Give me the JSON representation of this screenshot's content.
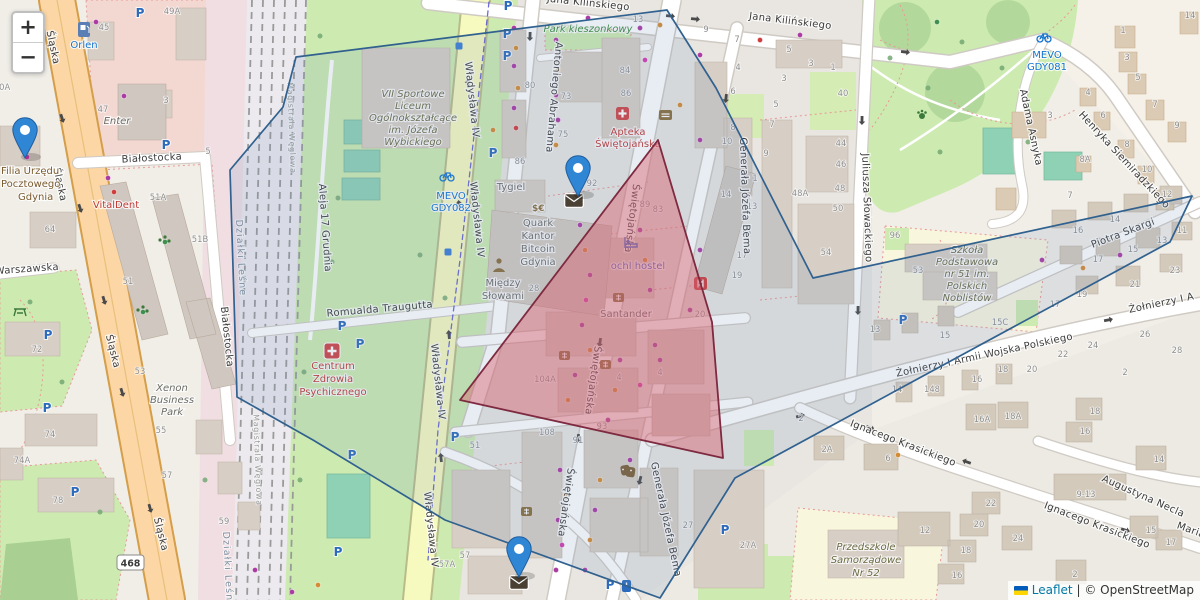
{
  "ui": {
    "zoom_in": "+",
    "zoom_out": "−",
    "attribution_leaflet": "Leaflet",
    "attribution_sep": "|",
    "attribution_osm": "© OpenStreetMap"
  },
  "icons": {
    "parking": "P",
    "currency": "$€"
  },
  "streets": {
    "slaska": "Śląska",
    "bialostocka": "Białostocka",
    "warszawska": "Warszawska",
    "wladyslawa": "Władysława IV",
    "swietojanska": "Świętojańska",
    "abrahama": "Antoniego Abrahama",
    "kilinskiego": "Jana Kilińskiego",
    "bema": "Generała Józefa Bema",
    "slowackiego": "Juliusza Słowackiego",
    "siemiradzkiego": "Henryka Siemiradzkiego",
    "asnyka": "Adama Asnyka",
    "skargi": "Piotra Skargi",
    "zolnierzy": "Żołnierzy I Armii Wojska Polskiego",
    "zolnierzy_clip": "Żołnierzy I A",
    "krasickiego": "Ignacego Krasickiego",
    "necla": "Augustyna Necla",
    "traugutta": "Romualda Traugutta",
    "grudnia": "Aleja 17 Grudnia",
    "maria": "Maria",
    "ref_468": "468"
  },
  "areas": {
    "dzialki": "Działki Leśne",
    "magistrala": "Magistrala Węglowa",
    "park_kieszonkowy": "Park kieszonkowy"
  },
  "pois": {
    "orlen": "Orlen",
    "vitaldent": "VitalDent",
    "enter": "Enter",
    "tygiel": "Tygiel",
    "santander": "Santander",
    "ochl": "ochl hostel",
    "filia": {
      "l1": "Filia Urzędu",
      "l2": "Pocztowego",
      "l3": "Gdynia"
    },
    "xenon": {
      "l1": "Xenon",
      "l2": "Business",
      "l3": "Park"
    },
    "liceum": {
      "l1": "VII Sportowe",
      "l2": "Liceum",
      "l3": "Ogólnokształcące",
      "l4": "im. Józefa",
      "l5": "Wybickiego"
    },
    "apteka": {
      "l1": "Apteka",
      "l2": "Świętojańska"
    },
    "quark": {
      "l1": "Quark",
      "l2": "Kantor",
      "l3": "Bitcoin",
      "l4": "Gdynia"
    },
    "miedzy": {
      "l1": "Między",
      "l2": "Słowami"
    },
    "centrum": {
      "l1": "Centrum",
      "l2": "Zdrowia",
      "l3": "Psychicznego"
    },
    "szkola": {
      "l1": "Szkoła",
      "l2": "Podstawowa",
      "l3": "nr 51 im.",
      "l4": "Polskich",
      "l5": "Noblistów"
    },
    "przedszkole": {
      "l1": "Przedszkole",
      "l2": "Samorządowe",
      "l3": "Nr 52"
    },
    "mevo1": {
      "l1": "MEVO",
      "l2": "GDY081"
    },
    "mevo2": {
      "l1": "MEVO",
      "l2": "GDY082"
    }
  },
  "colors": {
    "marker": "#2f86d4",
    "polygon_blue_stroke": "#30618f",
    "polygon_red_stroke": "#7e2a40",
    "road_primary": "#fcd6a4",
    "road_secondary": "#f7fabf",
    "green": "#cdebb0",
    "pitch": "#8ed1b4",
    "link": "#0078A8"
  },
  "map_points": {
    "markers": [
      {
        "x": 25,
        "y": 158
      },
      {
        "x": 578,
        "y": 196
      },
      {
        "x": 519,
        "y": 577
      }
    ],
    "post_envelopes": [
      [
        574,
        200
      ],
      [
        519,
        582
      ]
    ],
    "house_numbers": [
      [
        104,
        30,
        "45"
      ],
      [
        172,
        14,
        "49A"
      ],
      [
        103,
        112,
        "47"
      ],
      [
        166,
        103,
        "3"
      ],
      [
        208,
        154,
        "5"
      ],
      [
        2,
        90,
        "60A"
      ],
      [
        158,
        200,
        "51A"
      ],
      [
        200,
        242,
        "51B"
      ],
      [
        128,
        284,
        "51"
      ],
      [
        50,
        232,
        "64"
      ],
      [
        37,
        352,
        "72"
      ],
      [
        50,
        437,
        "74"
      ],
      [
        22,
        463,
        "74A"
      ],
      [
        58,
        503,
        "78"
      ],
      [
        161,
        433,
        "55"
      ],
      [
        167,
        478,
        "57"
      ],
      [
        224,
        524,
        "59"
      ],
      [
        140,
        374,
        "53"
      ],
      [
        530,
        88,
        "80"
      ],
      [
        566,
        99,
        "73"
      ],
      [
        563,
        137,
        "75"
      ],
      [
        625,
        73,
        "84"
      ],
      [
        626,
        96,
        "86"
      ],
      [
        520,
        164,
        "86"
      ],
      [
        592,
        186,
        "92"
      ],
      [
        638,
        22,
        "13"
      ],
      [
        706,
        32,
        "9"
      ],
      [
        737,
        42,
        "7"
      ],
      [
        738,
        70,
        "4"
      ],
      [
        733,
        94,
        "6"
      ],
      [
        733,
        130,
        "8"
      ],
      [
        727,
        144,
        "10"
      ],
      [
        726,
        197,
        "14"
      ],
      [
        789,
        52,
        "5"
      ],
      [
        811,
        66,
        "3"
      ],
      [
        833,
        70,
        "1"
      ],
      [
        843,
        96,
        "40"
      ],
      [
        784,
        81,
        "3"
      ],
      [
        776,
        107,
        "5"
      ],
      [
        772,
        127,
        "7"
      ],
      [
        766,
        156,
        "9"
      ],
      [
        841,
        146,
        "44"
      ],
      [
        841,
        167,
        "46"
      ],
      [
        840,
        191,
        "48"
      ],
      [
        838,
        211,
        "50"
      ],
      [
        826,
        255,
        "54"
      ],
      [
        800,
        196,
        "48A"
      ],
      [
        755,
        181,
        "1"
      ],
      [
        752,
        209,
        "13"
      ],
      [
        746,
        235,
        "15"
      ],
      [
        742,
        258,
        "17"
      ],
      [
        737,
        278,
        "19"
      ],
      [
        895,
        238,
        "96"
      ],
      [
        534,
        291,
        "28"
      ],
      [
        545,
        382,
        "104A"
      ],
      [
        578,
        443,
        "91"
      ],
      [
        619,
        380,
        "4"
      ],
      [
        700,
        317,
        "20"
      ],
      [
        645,
        207,
        "89"
      ],
      [
        658,
        212,
        "83"
      ],
      [
        602,
        429,
        "93"
      ],
      [
        547,
        435,
        "108"
      ],
      [
        475,
        448,
        "51"
      ],
      [
        465,
        558,
        "57"
      ],
      [
        447,
        567,
        "57A"
      ],
      [
        688,
        528,
        "27"
      ],
      [
        748,
        548,
        "27A"
      ],
      [
        918,
        273,
        "53"
      ],
      [
        1000,
        325,
        "15C"
      ],
      [
        945,
        338,
        "15"
      ],
      [
        875,
        332,
        "13"
      ],
      [
        1078,
        233,
        "16"
      ],
      [
        1115,
        222,
        "14"
      ],
      [
        1098,
        262,
        "17"
      ],
      [
        1133,
        252,
        "15"
      ],
      [
        1162,
        243,
        "13"
      ],
      [
        1182,
        233,
        "11"
      ],
      [
        1135,
        287,
        "21"
      ],
      [
        1082,
        297,
        "19"
      ],
      [
        1055,
        307,
        "17"
      ],
      [
        1175,
        273,
        "23"
      ],
      [
        1145,
        337,
        "26"
      ],
      [
        1177,
        353,
        "28"
      ],
      [
        1093,
        348,
        "24"
      ],
      [
        1063,
        357,
        "22"
      ],
      [
        1003,
        372,
        "18"
      ],
      [
        1032,
        372,
        "20"
      ],
      [
        977,
        382,
        "16"
      ],
      [
        897,
        392,
        "14"
      ],
      [
        932,
        392,
        "148"
      ],
      [
        1125,
        375,
        "2"
      ],
      [
        827,
        452,
        "2A"
      ],
      [
        888,
        461,
        "6"
      ],
      [
        925,
        533,
        "12"
      ],
      [
        991,
        506,
        "22"
      ],
      [
        979,
        527,
        "20"
      ],
      [
        966,
        553,
        "18"
      ],
      [
        957,
        578,
        "16"
      ],
      [
        1018,
        541,
        "24"
      ],
      [
        982,
        422,
        "16A"
      ],
      [
        1013,
        419,
        "18A"
      ],
      [
        1095,
        414,
        "18"
      ],
      [
        1085,
        434,
        "16"
      ],
      [
        1159,
        462,
        "14"
      ],
      [
        1086,
        497,
        "9-13"
      ],
      [
        1151,
        533,
        "15"
      ],
      [
        1171,
        545,
        "17"
      ],
      [
        1075,
        577,
        "2"
      ],
      [
        801,
        421,
        "2"
      ],
      [
        660,
        375,
        "4"
      ],
      [
        1123,
        33,
        "1"
      ],
      [
        1127,
        60,
        "3"
      ],
      [
        1138,
        80,
        "5"
      ],
      [
        1155,
        107,
        "7"
      ],
      [
        1177,
        128,
        "9"
      ],
      [
        1190,
        18,
        "14"
      ],
      [
        1088,
        95,
        "4"
      ],
      [
        1103,
        118,
        "6"
      ],
      [
        1127,
        147,
        "8"
      ],
      [
        1085,
        162,
        "8A"
      ],
      [
        1147,
        172,
        "10"
      ],
      [
        1050,
        118,
        "3"
      ],
      [
        1070,
        198,
        "7"
      ],
      [
        1167,
        197,
        "12"
      ]
    ],
    "shop_dots": [
      [
        96,
        22,
        "p"
      ],
      [
        27,
        157,
        "m"
      ],
      [
        108,
        178,
        "p"
      ],
      [
        114,
        192,
        "r"
      ],
      [
        124,
        96,
        "p"
      ],
      [
        514,
        28,
        "p"
      ],
      [
        516,
        48,
        "o"
      ],
      [
        514,
        66,
        "p"
      ],
      [
        518,
        88,
        "o"
      ],
      [
        514,
        108,
        "p"
      ],
      [
        516,
        128,
        "r"
      ],
      [
        493,
        130,
        "o"
      ],
      [
        556,
        40,
        "p"
      ],
      [
        558,
        70,
        "o"
      ],
      [
        556,
        95,
        "p"
      ],
      [
        558,
        120,
        "p"
      ],
      [
        556,
        145,
        "o"
      ],
      [
        588,
        18,
        "p"
      ],
      [
        610,
        30,
        "o"
      ],
      [
        640,
        28,
        "p"
      ],
      [
        660,
        25,
        "o"
      ],
      [
        700,
        55,
        "p"
      ],
      [
        760,
        40,
        "r"
      ],
      [
        800,
        35,
        "p"
      ],
      [
        645,
        60,
        "m"
      ],
      [
        680,
        105,
        "o"
      ],
      [
        700,
        140,
        "p"
      ],
      [
        580,
        225,
        "p"
      ],
      [
        585,
        250,
        "o"
      ],
      [
        590,
        275,
        "p"
      ],
      [
        586,
        300,
        "m"
      ],
      [
        582,
        325,
        "p"
      ],
      [
        590,
        350,
        "o"
      ],
      [
        640,
        230,
        "p"
      ],
      [
        645,
        260,
        "o"
      ],
      [
        650,
        290,
        "p"
      ],
      [
        645,
        315,
        "m"
      ],
      [
        655,
        345,
        "p"
      ],
      [
        575,
        375,
        "p"
      ],
      [
        568,
        400,
        "o"
      ],
      [
        620,
        360,
        "p"
      ],
      [
        615,
        390,
        "o"
      ],
      [
        608,
        420,
        "p"
      ],
      [
        640,
        385,
        "m"
      ],
      [
        660,
        360,
        "p"
      ],
      [
        560,
        470,
        "p"
      ],
      [
        565,
        495,
        "o"
      ],
      [
        558,
        520,
        "p"
      ],
      [
        562,
        545,
        "m"
      ],
      [
        556,
        570,
        "p"
      ],
      [
        600,
        480,
        "o"
      ],
      [
        595,
        510,
        "p"
      ],
      [
        590,
        540,
        "o"
      ],
      [
        585,
        570,
        "p"
      ],
      [
        630,
        460,
        "p"
      ],
      [
        700,
        250,
        "p"
      ],
      [
        705,
        280,
        "o"
      ],
      [
        690,
        310,
        "p"
      ],
      [
        292,
        592,
        "p"
      ],
      [
        318,
        585,
        "o"
      ],
      [
        255,
        570,
        "p"
      ],
      [
        1042,
        260,
        "p"
      ],
      [
        1120,
        255,
        "p"
      ],
      [
        1083,
        268,
        "o"
      ],
      [
        898,
        455,
        "o"
      ],
      [
        937,
        22,
        "g"
      ],
      [
        165,
        242,
        "g"
      ],
      [
        143,
        312,
        "g"
      ],
      [
        459,
        46,
        "b"
      ],
      [
        448,
        252,
        "b"
      ]
    ],
    "parking": [
      [
        140,
        13
      ],
      [
        508,
        6
      ],
      [
        507,
        34
      ],
      [
        507,
        56
      ],
      [
        493,
        153
      ],
      [
        166,
        145
      ],
      [
        48,
        335
      ],
      [
        47,
        408
      ],
      [
        75,
        492
      ],
      [
        342,
        326
      ],
      [
        360,
        344
      ],
      [
        352,
        455
      ],
      [
        338,
        552
      ],
      [
        455,
        437
      ],
      [
        610,
        585
      ],
      [
        725,
        530
      ],
      [
        903,
        320
      ]
    ],
    "trees": [
      [
        320,
        36
      ],
      [
        338,
        198
      ],
      [
        332,
        262
      ],
      [
        304,
        372
      ],
      [
        300,
        480
      ],
      [
        420,
        255
      ],
      [
        445,
        298
      ],
      [
        890,
        58
      ],
      [
        928,
        88
      ],
      [
        962,
        42
      ],
      [
        1002,
        68
      ],
      [
        940,
        152
      ],
      [
        1028,
        142
      ],
      [
        30,
        302
      ],
      [
        62,
        382
      ],
      [
        100,
        512
      ],
      [
        142,
        562
      ],
      [
        205,
        480
      ]
    ],
    "arrows": [
      [
        62,
        118,
        72
      ],
      [
        80,
        208,
        72
      ],
      [
        104,
        300,
        73
      ],
      [
        122,
        392,
        73
      ],
      [
        150,
        508,
        74
      ],
      [
        468,
        84,
        -96
      ],
      [
        459,
        205,
        -96
      ],
      [
        449,
        335,
        -96
      ],
      [
        441,
        458,
        -96
      ],
      [
        670,
        16,
        6
      ],
      [
        695,
        19,
        6
      ],
      [
        905,
        52,
        7
      ],
      [
        800,
        416,
        -15
      ],
      [
        1108,
        320,
        -11
      ],
      [
        726,
        98,
        97
      ],
      [
        640,
        480,
        104
      ],
      [
        600,
        342,
        99
      ],
      [
        578,
        438,
        99
      ],
      [
        862,
        120,
        91
      ],
      [
        858,
        310,
        91
      ],
      [
        870,
        428,
        24
      ],
      [
        1125,
        530,
        17
      ],
      [
        967,
        462,
        200
      ],
      [
        530,
        36,
        92
      ]
    ]
  }
}
